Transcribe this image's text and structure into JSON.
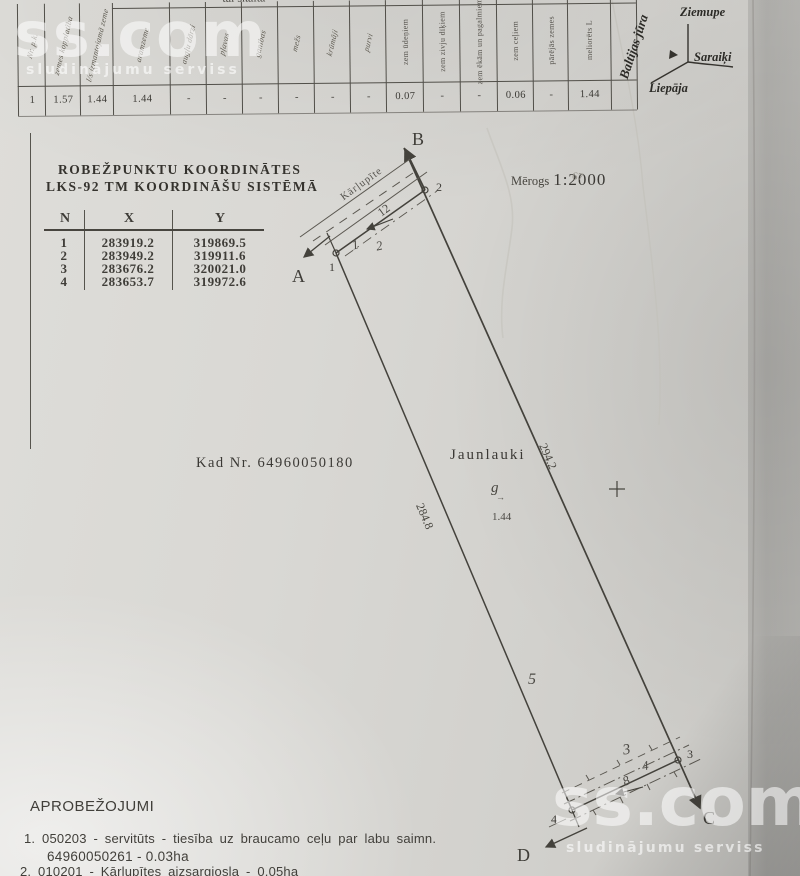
{
  "watermark": {
    "brand": "ss.com",
    "tagline": "sludinājumu serviss"
  },
  "land_table": {
    "span_header": "tai skaitā",
    "columns": [
      {
        "label": "Nr. p.k.",
        "value": "1"
      },
      {
        "label": "zemes kopplatība",
        "value": "1.57"
      },
      {
        "label": "l/s izmantojamā zeme",
        "value": "1.44"
      },
      {
        "label": "aramzeme",
        "value": "1.44"
      },
      {
        "label": "augļu dārzi",
        "value": "-"
      },
      {
        "label": "pļavas",
        "value": "-"
      },
      {
        "label": "ganības",
        "value": "-"
      },
      {
        "label": "mežs",
        "value": "-"
      },
      {
        "label": "krūmāji",
        "value": "-"
      },
      {
        "label": "purvi",
        "value": "-"
      },
      {
        "label": "zem ūdeņiem",
        "value": "0.07"
      },
      {
        "label": "zem zivju dīķiem",
        "value": "-"
      },
      {
        "label": "zem ēkām un pagalmiem",
        "value": "-"
      },
      {
        "label": "zem ceļiem",
        "value": "0.06"
      },
      {
        "label": "pārējās zemes",
        "value": "-"
      },
      {
        "label": "meliorēts L",
        "value": "1.44"
      }
    ]
  },
  "location_sketch": {
    "sea": "Baltijas jūra",
    "town_north": "Ziemupe",
    "town_east": "Saraiķi",
    "town_south": "Liepāja"
  },
  "coordinates": {
    "title_line1": "ROBEŽPUNKTU KOORDINĀTES",
    "title_line2": "LKS-92 TM KOORDINĀŠU SISTĒMĀ",
    "col_n": "N",
    "col_x": "X",
    "col_y": "Y",
    "rows": [
      {
        "n": "1",
        "x": "283919.2",
        "y": "319869.5"
      },
      {
        "n": "2",
        "x": "283949.2",
        "y": "319911.6"
      },
      {
        "n": "3",
        "x": "283676.2",
        "y": "320021.0"
      },
      {
        "n": "4",
        "x": "283653.7",
        "y": "319972.6"
      }
    ]
  },
  "scale": {
    "label": "Mērogs",
    "value": "1:2000"
  },
  "cadastre": {
    "text": "Kad Nr. 64960050180"
  },
  "plan": {
    "name": "Jaunlauki",
    "dir_a": "A",
    "dir_b": "B",
    "dir_c": "C",
    "dir_d": "D",
    "v1": "1",
    "v2": "2",
    "v3": "3",
    "v4": "4",
    "seg1": "1",
    "seg2": "2",
    "seg3": "3",
    "seg4": "4",
    "seg5": "5",
    "stream_name": "Kārļupīte",
    "stream_width": "12",
    "road_width": "8",
    "side_right": "294.2",
    "side_left": "284.8",
    "landuse_symbol": "g",
    "landuse_arrow_glyph": "→",
    "landuse_area": "1.44",
    "pencil_note": "67"
  },
  "restrictions": {
    "title": "APROBEŽOJUMI",
    "line1": "1. 050203 - servitūts - tiesība uz braucamo ceļu par labu saimn.",
    "line2": "64960050261 - 0.03ha",
    "line3": "2. 010201 - Kārļupītes aizsargjosla - 0.05ha"
  }
}
